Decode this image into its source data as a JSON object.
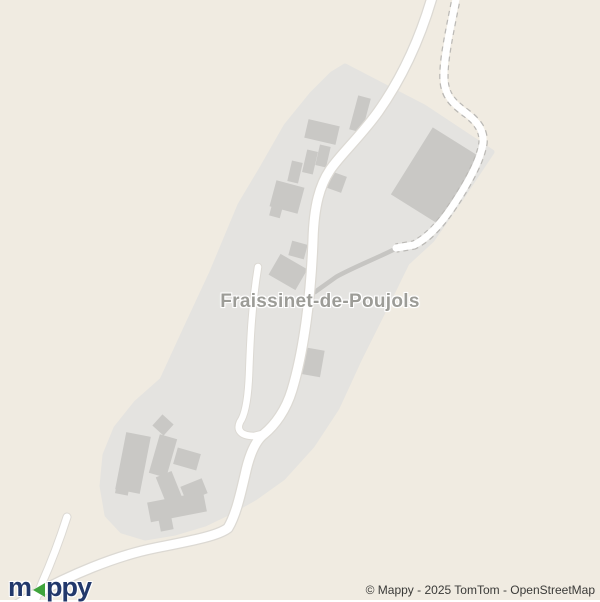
{
  "map": {
    "place_label": "Fraissinet-de-Poujols",
    "attribution": "© Mappy - 2025 TomTom - OpenStreetMap",
    "logo": {
      "part1": "m",
      "arrow_icon": "left-triangle",
      "part2": "ppy"
    }
  },
  "colors": {
    "background": "#f0ebe1",
    "urban": "#e4e3e0",
    "building": "#c9c8c5",
    "road_fill": "#ffffff",
    "road_casing": "#dcd9d3",
    "road_dash_casing": "#bbb9b5",
    "track": "#c6c5c2",
    "label": "#9c9c97",
    "label_halo": "#ffffff",
    "attribution": "#3a3a38",
    "logo_blue": "#22386b",
    "logo_green": "#3fa43c"
  }
}
